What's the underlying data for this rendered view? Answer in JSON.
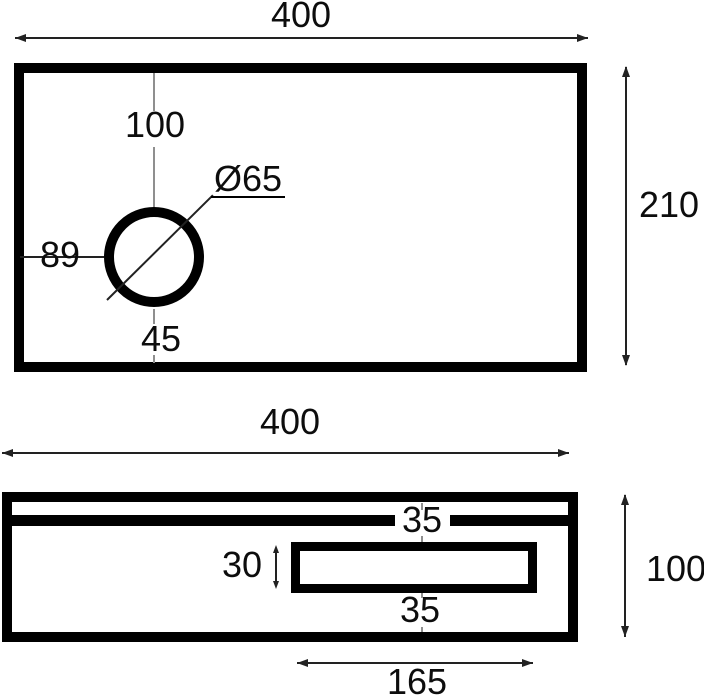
{
  "drawing": {
    "top_view": {
      "width_label": "400",
      "height_label": "210",
      "hole": {
        "diameter_label": "Ø65",
        "from_top_label": "100",
        "from_left_label": "89",
        "from_bottom_label": "45"
      }
    },
    "side_view": {
      "width_label": "400",
      "height_label": "100",
      "slot": {
        "upper_gap_label": "35",
        "height_label": "30",
        "lower_gap_label": "35",
        "length_label": "165"
      }
    },
    "colors": {
      "outline": "#000000",
      "dimension_line": "#222222",
      "centerline": "#8f8f8f",
      "background": "#ffffff"
    }
  }
}
